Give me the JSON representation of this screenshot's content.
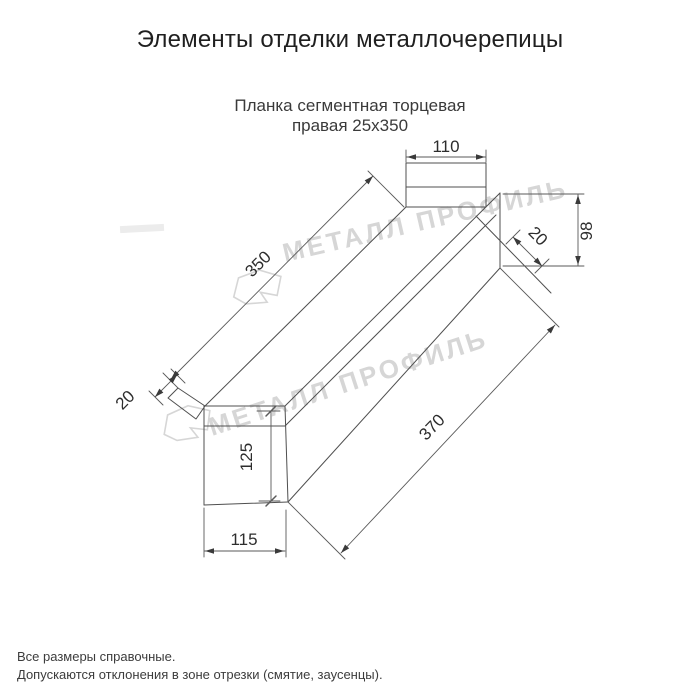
{
  "header": {
    "title": "Элементы отделки металлочерепицы"
  },
  "product": {
    "subtitle_line1": "Планка сегментная торцевая",
    "subtitle_line2": "правая 25x350"
  },
  "drawing": {
    "type": "technical-dimension-drawing",
    "dimensions": {
      "top_tab_width": "110",
      "top_face_length": "350",
      "near_fold": "20",
      "end_fold": "20",
      "end_height": "98",
      "bottom_length": "370",
      "front_height": "125",
      "front_width": "115"
    },
    "watermark": {
      "text": "МЕТАЛЛ ПРОФИЛЬ",
      "color": "#d6d6d6"
    }
  },
  "footer": {
    "note1": "Все размеры справочные.",
    "note2": "Допускаются отклонения в зоне отрезки (смятие, заусенцы)."
  },
  "colors": {
    "background": "#ffffff",
    "outline": "#4f4f4f",
    "dimension_lines": "#5a5a5a",
    "text": "#2d2d2d"
  }
}
